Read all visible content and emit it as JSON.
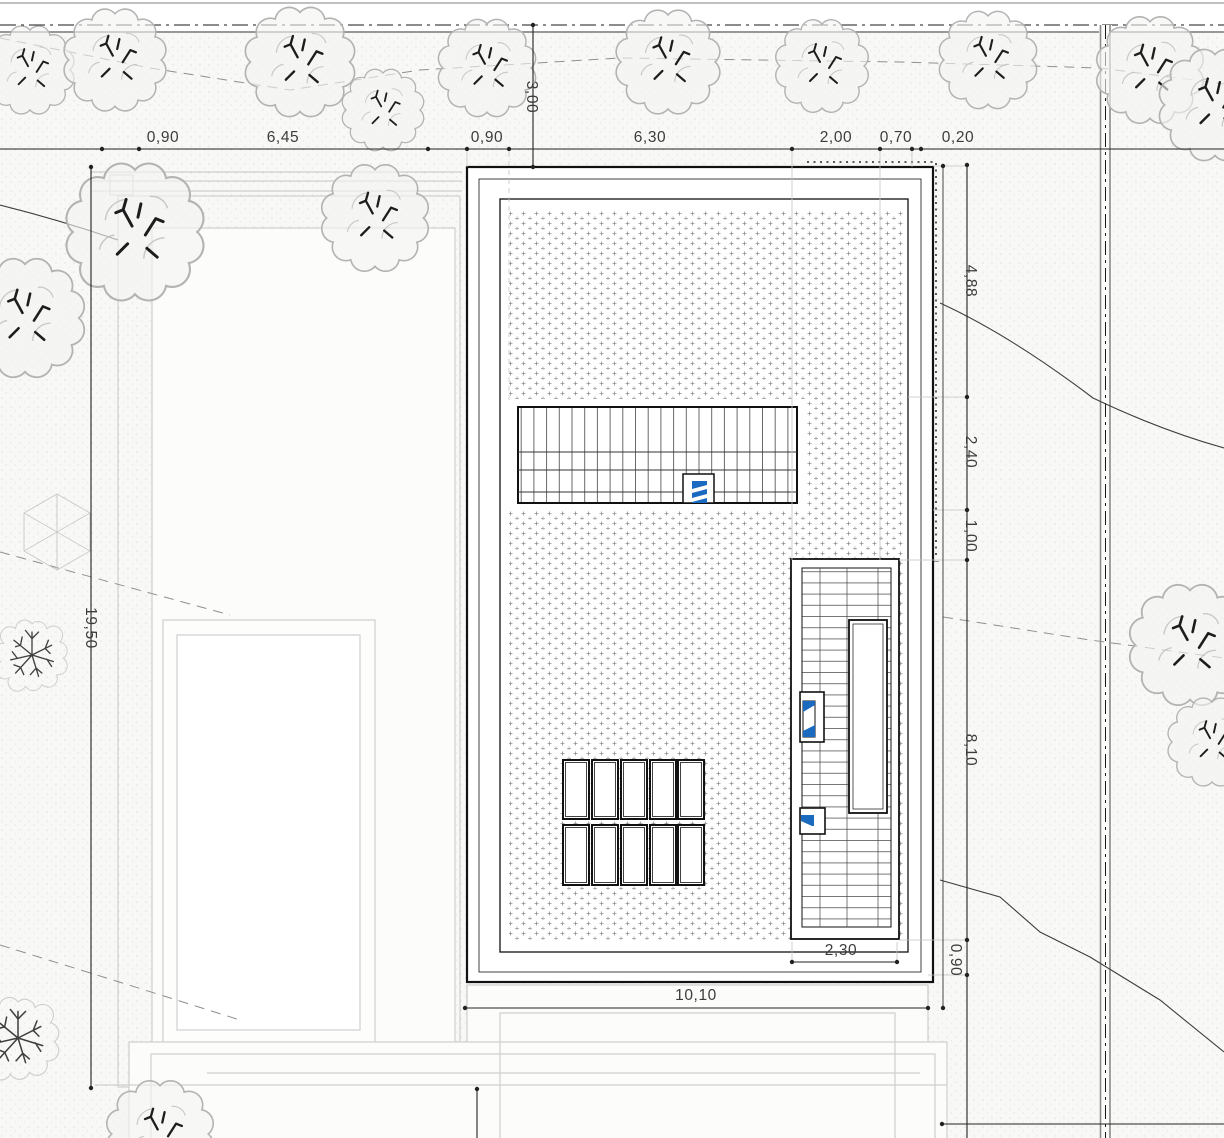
{
  "drawing": {
    "dims": {
      "top": [
        "0,90",
        "6,45",
        "0,90",
        "6,30",
        "2,00",
        "0,70",
        "0,20"
      ],
      "street_setback": "3,00",
      "right": [
        "4,88",
        "2,40",
        "1,00",
        "8,10",
        "0,90"
      ],
      "left_height": "19,50",
      "bottom_width": "10,10",
      "strip_width": "2,30"
    },
    "colors": {
      "line_black": "#1c1c1c",
      "road_gray": "#8a8a8a",
      "terrace_gray": "#cfcfcf",
      "tree_gray": "#b3b3b3",
      "dim_text": "#3c3c3c",
      "accent_blue": "#1a6ac0",
      "paper": "#f7f7f6"
    },
    "symbols": {
      "tree": "deciduous-tree-crown-icon",
      "bare_tree": "bare-branch-tree-icon",
      "parasol": "hexagon-parasol-icon",
      "skylight_marker": "blue-glazing-marker-icon"
    }
  }
}
